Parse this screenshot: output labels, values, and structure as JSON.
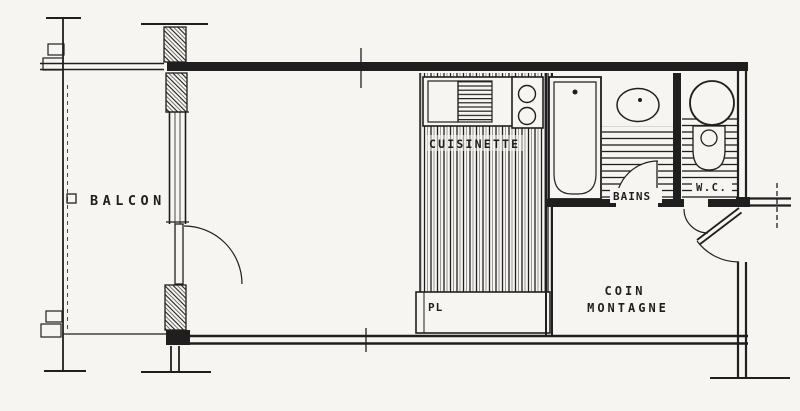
{
  "colors": {
    "ink": "#1f1f1f",
    "paper": "#f6f5f1"
  },
  "rooms": {
    "balcony": {
      "label": "BALCON"
    },
    "kitchenette": {
      "label": "CUISINETTE"
    },
    "closet": {
      "label": "PL"
    },
    "bathroom": {
      "label": "BAINS"
    },
    "wc": {
      "label": "W.C."
    },
    "mountain_corner": {
      "label_line1": "COIN",
      "label_line2": "MONTAGNE"
    }
  }
}
